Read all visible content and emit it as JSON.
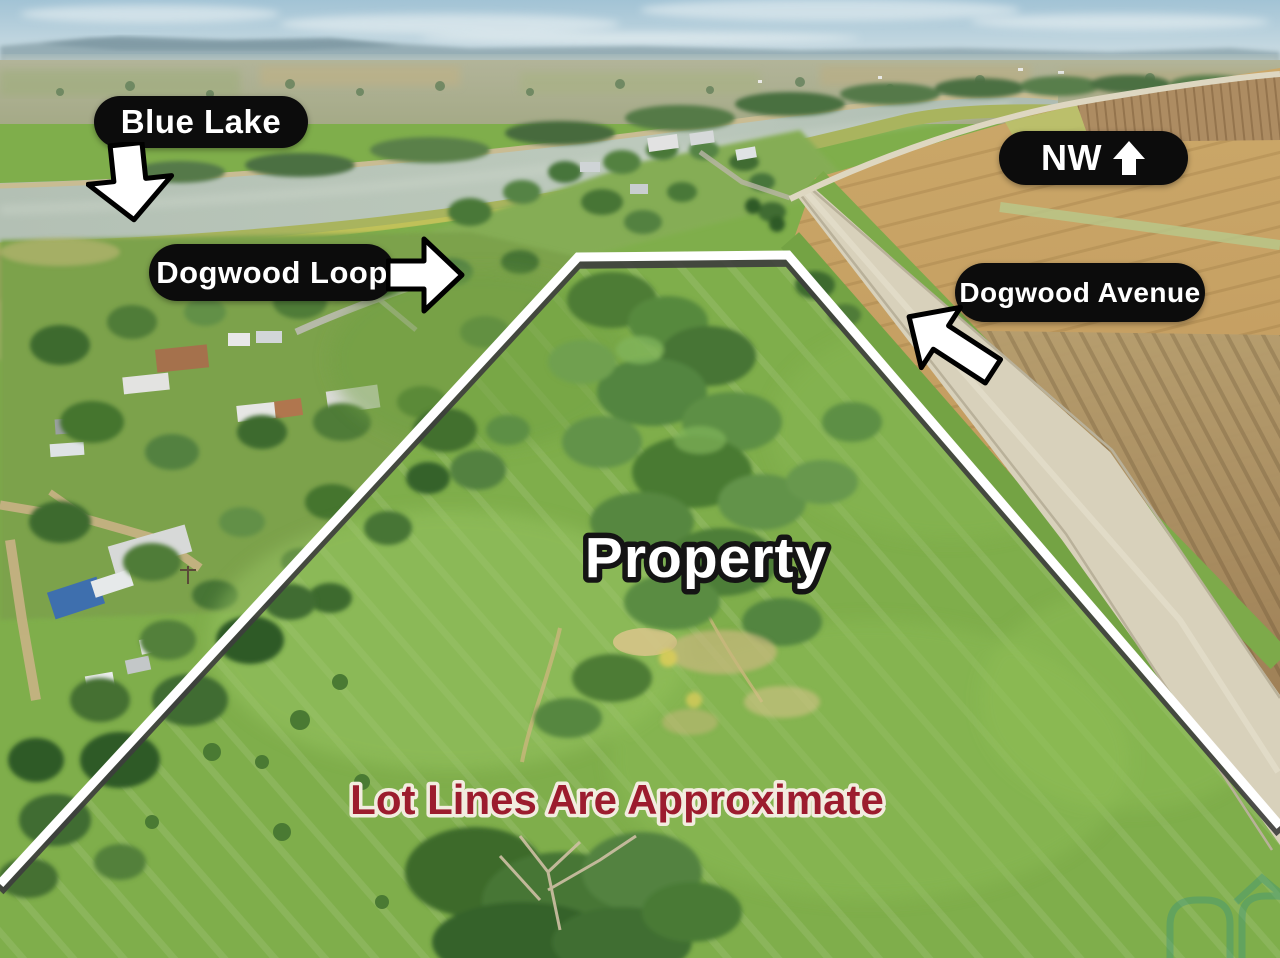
{
  "annotations": {
    "blue_lake": {
      "label": "Blue Lake",
      "arrow_direction": "down"
    },
    "dogwood_loop": {
      "label": "Dogwood Loop",
      "arrow_direction": "right"
    },
    "compass": {
      "label": "NW",
      "arrow_direction": "up"
    },
    "dogwood_avenue": {
      "label": "Dogwood Avenue",
      "arrow_direction": "down-left"
    },
    "property": {
      "label": "Property"
    },
    "disclaimer": {
      "label": "Lot Lines Are Approximate"
    }
  },
  "icons": {
    "blue_lake_arrow": "arrow-down-icon",
    "dogwood_loop_arrow": "arrow-right-icon",
    "dogwood_avenue_arrow": "arrow-down-left-icon",
    "compass_arrow": "arrow-up-icon",
    "watermark": "house-roof-logo-watermark"
  },
  "colors": {
    "label_bg": "#0c0c0c",
    "label_text": "#ffffff",
    "arrow_fill": "#ffffff",
    "arrow_outline": "#000000",
    "boundary_line": "#ffffff",
    "boundary_shadow": "#3d3d3d",
    "property_text_fill": "#ffffff",
    "property_text_outline": "#141414",
    "disclaimer_fill": "#9c1c2e",
    "disclaimer_outline": "#f2ecdf",
    "watermark_teal": "#2f8f84",
    "grass_green": "#7fae4b",
    "road_gravel": "#d8d1bb",
    "water": "#b5c2b6",
    "gold_field": "#c5a067"
  }
}
